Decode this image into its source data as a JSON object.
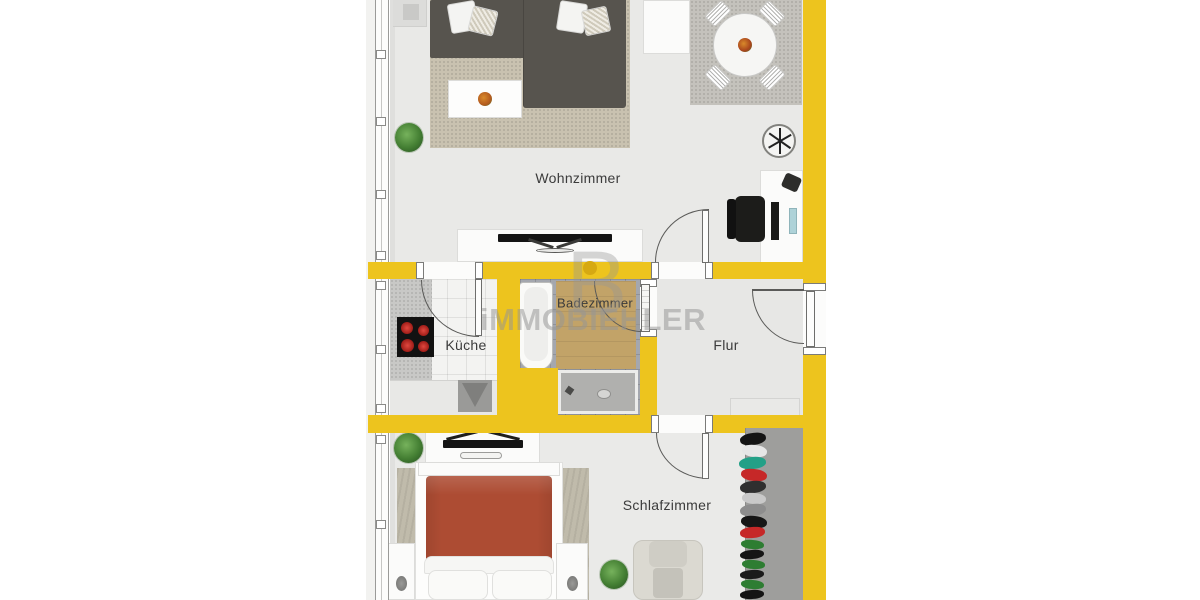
{
  "rooms": {
    "living": "Wohnzimmer",
    "kitchen": "Küche",
    "bath": "Badezimmer",
    "hall": "Flur",
    "bedroom": "Schlafzimmer"
  },
  "watermark": {
    "logo_letter": "B",
    "brand": "iMMOBIEHLER"
  },
  "colors": {
    "wall_yellow": "#edc41e",
    "floor_light": "#e9e9e7",
    "bath_tile": "#a4a7ae",
    "kitchen_tile": "#f3f3f1",
    "bed_cover": "#ad4c33",
    "sofa_gray": "#57544e",
    "rug_beige": "#c9c2b0",
    "wardrobe_gray": "#9e9e9c",
    "label_text": "#3b3b3b",
    "watermark_gray": "#969696"
  }
}
